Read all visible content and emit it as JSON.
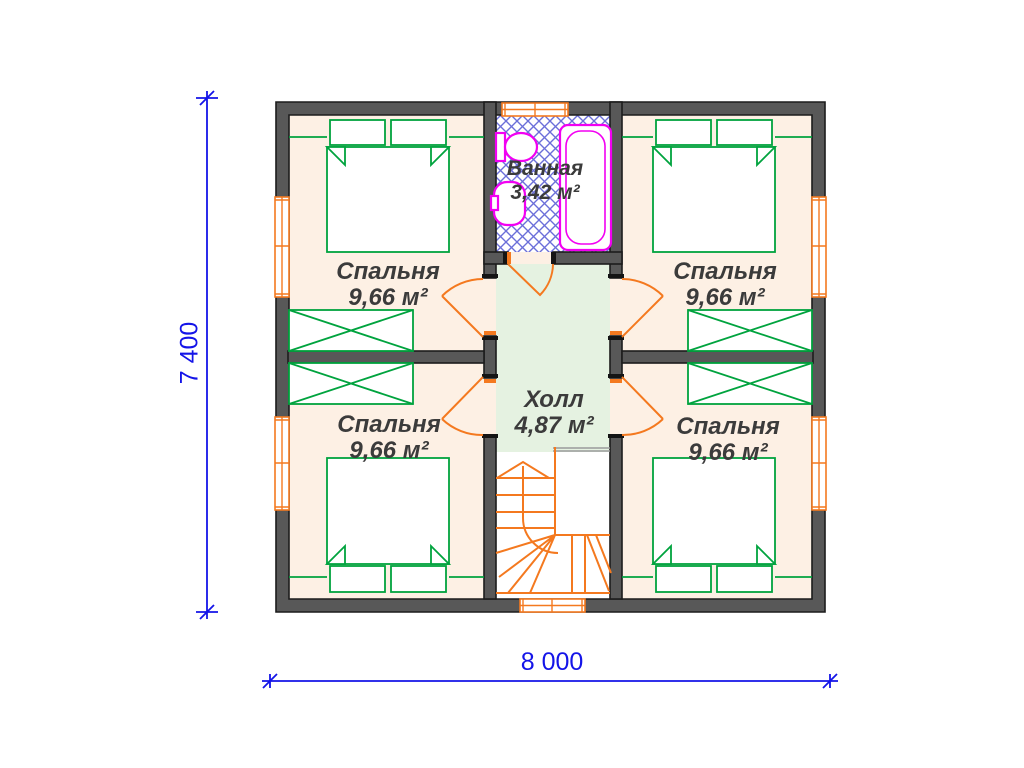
{
  "rooms": {
    "bedroom_tl": {
      "name": "Спальня",
      "area": "9,66 м²"
    },
    "bedroom_tr": {
      "name": "Спальня",
      "area": "9,66 м²"
    },
    "bedroom_bl": {
      "name": "Спальня",
      "area": "9,66 м²"
    },
    "bedroom_br": {
      "name": "Спальня",
      "area": "9,66 м²"
    },
    "bathroom": {
      "name": "Ванная",
      "area": "3,42 м²"
    },
    "hall": {
      "name": "Холл",
      "area": "4,87 м²"
    }
  },
  "dimensions": {
    "width": "8 000",
    "height": "7 400"
  },
  "colors": {
    "wall": "#585858",
    "floor": "#fdf0e4",
    "hall_floor": "#e5f2e1",
    "furniture": "#00a33e",
    "fittings": "#f4791f",
    "sanitary": "#f200f2",
    "hatch": "#6b6fd9",
    "dimension": "#1414e8",
    "label_text": "#3b3b3b"
  }
}
